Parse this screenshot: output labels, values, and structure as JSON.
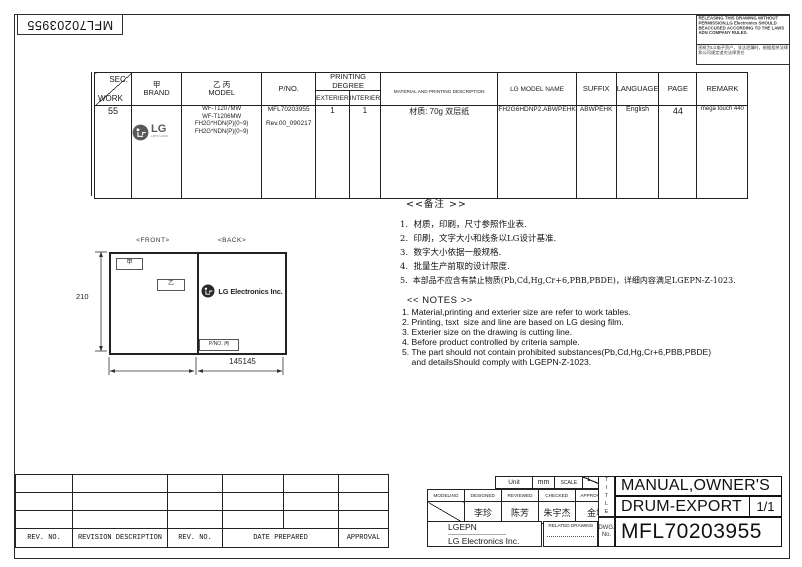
{
  "colors": {
    "lg_logo_gray": "#58595b",
    "line": "#222222"
  },
  "page": {
    "doc_number_top": "MFL70203955",
    "warning_en": "RELEASING THIS DRAWING WITHOUT PERMISSION,LG Electronics SHOULD BEACCUSED ACCORDING TO THE LAWS ADN COMPANY RULES.",
    "warning_cn": "图纸为LG电子资产，非法泄漏时，根据相关法律和公司规定追究法律责任"
  },
  "spec_table": {
    "headers": {
      "sec": "SEC.",
      "work": "WORK",
      "brand_top": "甲",
      "brand": "BRAND",
      "model_top": "乙 丙",
      "model": "MODEL",
      "pno": "P/NO.",
      "printing_degree": "PRINTING DEGREE",
      "exterier": "EXTERIER",
      "interier": "INTERIER",
      "material": "MATERIAL AND PRINTING DESCRIPTION",
      "lg_model_name": "LG MODEL NAME",
      "suffix": "SUFFIX",
      "language": "LANGUAGE",
      "page": "PAGE",
      "remark": "REMARK"
    },
    "row": {
      "work": "55",
      "brand_wordmark": "LG",
      "brand_tagline": "Life's Good",
      "models": [
        "WF-T1207MW",
        "WF-T1206MW",
        "FH2G*HDN(P)(0~9)",
        "FH2G*NDN(P)(0~9)"
      ],
      "pno1": "MFL70203955",
      "pno2": "Rev.00_090217",
      "exterier": "1",
      "interier": "1",
      "material": "材质: 70g 双层纸",
      "lg_model_name": "FH2G6HDNP2.ABWPEHK",
      "suffix": "ABWPEHK",
      "language": "English",
      "page": "44",
      "remark": "mega touch 440"
    }
  },
  "drawing": {
    "front_label": "<FRONT>",
    "back_label": "<BACK>",
    "front_tag_a": "甲",
    "front_tag_b": "乙",
    "back_logo_text": "LG Electronics Inc.",
    "pno_tag": "P/NO. 丙",
    "dim_height": "210",
    "dim_width": "145145"
  },
  "notes_cn": {
    "title": "<<备注 >>",
    "items": [
      "1.  材质，印刷，尺寸参照作业表.",
      "2.  印刷，文字大小和线条以LG设计基准.",
      "3.  数字大小依据一般规格.",
      "4.  批量生产前取的设计限度.",
      "5.  本部品不应含有禁止物质(Pb,Cd,Hg,Cr+6,PBB,PBDE)，详细内容满足LGEPN-Z-1023."
    ]
  },
  "notes_en": {
    "title": "<< NOTES >>",
    "items": [
      "1. Material,printing and exterier size are refer to work tables.",
      "2. Printing, tsxt  size and line are based on LG desing film.",
      "3. Exterier size on the drawing is cutting line.",
      "4. Before product controlled by criteria sample.",
      "5. The part should not contain prohibited substances(Pb,Cd,Hg,Cr+6,PBB,PBDE)",
      "    and detailsShould comply with LGEPN-Z-1023."
    ]
  },
  "revision_table": {
    "labels": [
      "REV. NO.",
      "REVISION DESCRIPTION",
      "REV. NO.",
      "DATE PREPARED",
      "APPROVAL"
    ]
  },
  "title_block": {
    "unit_label": "Unit",
    "unit_value": "mm",
    "scale_label": "SCALE",
    "scale_num": "1",
    "scale_den": "1",
    "sign_headers": [
      "MODELING",
      "DESIGNED",
      "REVIEWED",
      "CHECKED",
      "APPROVALED"
    ],
    "signers": [
      "李珍",
      "陈芳",
      "朱宇杰",
      "金坤"
    ],
    "company_short": "LGEPN",
    "company_full": "LG Electronics Inc.",
    "related_drawing": "RELATED DRAWING",
    "dwg_no_label": "DWG. No.",
    "title_vertical": "TITLE",
    "title_line1": "MANUAL,OWNER'S",
    "title_line2": "DRUM-EXPORT",
    "sheet_no": "1/1",
    "dwg_number": "MFL70203955"
  }
}
